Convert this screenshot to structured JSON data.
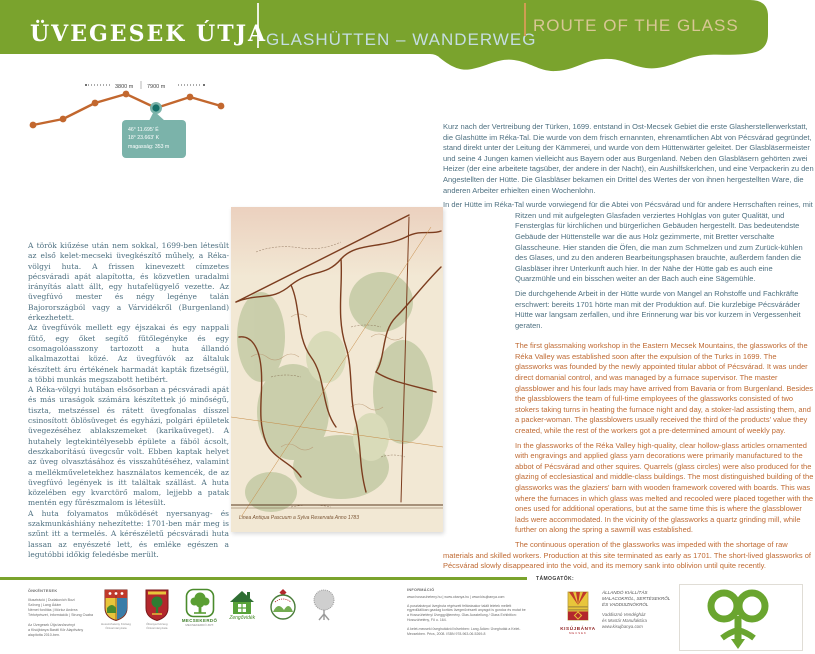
{
  "header": {
    "title_hu": "ÜVEGESEK ÚTJA",
    "title_de": "GLASHÜTTEN – WANDERWEG",
    "title_en": "ROUTE OF THE GLASS",
    "band_color": "#7aa32d",
    "title_de_color": "#c5dde2",
    "title_en_color": "#d9c795"
  },
  "chart_data": {
    "type": "line",
    "title": "trail elevation profile",
    "distance_labels": [
      "3800 m",
      "7900 m"
    ],
    "x_rel": [
      15,
      45,
      77,
      108,
      138,
      172,
      203
    ],
    "y_rel": [
      49,
      43,
      27,
      18,
      32,
      21,
      30
    ],
    "highlight_index": 4,
    "tooltip": [
      "46° 11.695' É",
      "18° 23.663' K",
      "magasság: 353 m"
    ],
    "line_color": "#c2672e",
    "highlight_color": "#156f68",
    "highlight_ring": "#7bb3aa",
    "tooltip_color": "#7bb3aa"
  },
  "text": {
    "hu": "A török kiűzése után nem sokkal, 1699-ben létesült az első kelet-mecseki üvegkészítő műhely, a Réka-völgyi huta. A frissen kinevezett címzetes pécsváradi apát alapította, és közvetlen uradalmi irányítás alatt állt, egy hutafelügyelő vezette. Az üvegfúvó mester és négy legénye talán Bajorországból vagy a Várvidékről (Burgenland) érkezhetett.\nAz üvegfúvók mellett egy éjszakai és egy nappali fűtő, egy őket segítő fűtőlegényke és egy csomagolóasszony tartozott a huta állandó alkalmazottai közé. Az üvegfúvók az általuk készített áru értékének harmadát kapták fizetségül, a többi munkás megszabott hetibért.\nA Réka-völgyi hutában elsősorban a pécsváradi apát és más uraságok számára készítettek jó minőségű, tiszta, metszéssel és rátett üvegfonalas dísszel csinosított öblösüveget és egyházi, polgári épületek üvegezéséhez ablakszemeket (karikaüveget). A hutahely legtekintélyesebb épülete a fából ácsolt, deszkaborítású üvegcsűr volt. Ebben kaptak helyet az üveg olvasztásához és visszahűtéséhez, valamint a mellékműveletekhez használatos kemencék, de az üvegfúvó legények is itt találtak szállást. A huta közelében egy kvarctörő malom, lejjebb a patak mentén egy fűrészmalom is létesült.\nA huta folyamatos működését nyersanyag- és szakmunkáshiány nehezítette: 1701-ben már meg is szűnt itt a termelés. A kérészéletű pécsváradi huta lassan az enyészeté lett, és emléke egészen a legutóbbi időkig feledésbe merült.",
    "de": [
      "Kurz nach der Vertreibung der Türken, 1699. entstand in Ost-Mecsek Gebiet die erste Glasherstellerwerkstatt, die Glashütte im Réka-Tal. Die wurde von dem frisch ernannten, ehrenamtlichen Abt von Pécsvárad gegründet, stand direkt unter der Leitung der Kämmerei, und wurde von dem Hüttenwärter geleitet. Der Glasbläsermeister und seine 4 Jungen kamen vielleicht aus Bayern oder aus Burgenland. Neben den Glasbläsern gehörten zwei Heizer (der eine arbeitete tagsüber, der andere in der Nacht), ein Aushilfskerlchen, und eine Verpackerin zu den Angestellten der Hütte. Die Glasbläser bekamen ein Drittel des Wertes der von ihnen hergestellten Ware, die anderen Arbeiter erhielten einen Wochenlohn.",
      "In der Hütte im Réka-Tal wurde vorwiegend für die Abtei von Pécsvárad und für andere Herrschaften reines, mit Ritzen und mit aufgelegten Glasfaden verziertes Hohlglas von guter Qualität, und Fensterglas für kirchlichen und bürgerlichen Gebäuden hergestellt. Das bedeutendste Gebäude der Hüttenstelle war die aus Holz gezimmerte, mit Bretter verschalte Glasscheune. Hier standen die Öfen, die man zum Schmelzen und zum Zurück-kühlen des Glases, und zu den anderen Bearbeitungsphasen brauchte, außerdem fanden die Glasbläser ihrer Unterkunft auch hier. In der Nähe der Hütte gab es auch eine Quarzmühle und ein bisschen weiter an der Bach auch eine Sägemühle.",
      "Die durchgehende Arbeit in der Hütte wurde von Mangel an Rohstoffe und Fachkräfte erschwert: bereits 1701 hörte man mit der Produktion auf. Die kurzlebige Pécsváráder Hütte war langsam zerfallen, und ihre Erinnerung war bis vor kurzem in Vergessenheit geraten."
    ],
    "en": [
      "The first glassmaking workshop in the Eastern Mecsek Mountains, the glassworks of the Réka Valley was established soon after the expulsion of the Turks in 1699. The glassworks was founded by the newly appointed titular abbot of Pécsvárad. It was under direct domanial control, and was managed by a furnace supervisor. The master glassblower and his four lads may have arrived from Bavaria or from Burgenland. Besides the glassblowers the team of full-time employees of the glassworks consisted of two stokers taking turns in heating the furnace night and day, a stoker-lad assisting them, and a packer-woman. The glassblowers usually received the third of the products' value they created, while the rest of the workers got a pre-determined amount of weekly pay.",
      "In the glassworks of the Réka Valley high-quality, clear hollow-glass articles ornamented with engravings and applied glass yarn decorations were primarily manufactured to the abbot of Pécsvárad and other squires. Quarrels (glass circles) were also produced for the glazing of ecclesiastical and middle-class buildings. The most distinguished building of the glassworks was the glaziers' barn with wooden framework covered with boards. This was where the furnaces in which glass was melted and recooled were placed together with the ones used for additional operations, but at the same time this is where the glassblower lads were accommodated. In the vicinity of the glassworks a quartz grinding mill, while further on along the spring a sawmill was established.",
      "The continuous operation of the glassworks was impeded with the shortage of raw materials and skilled workers. Production at this site terminated as early as 1701. The short-lived glassworks of Pécsvárad slowly disappeared into the void, and its memory sank into oblivion until quite recently."
    ]
  },
  "map": {
    "caption": "Linea Antiqua Pascuum a Sylva Reservata Anno 1783"
  },
  "footer": {
    "credits": {
      "heading": "ÖNKÉNTESEK",
      "lines": [
        "Illusztráció | Dudakovich Bozi",
        "Szöveg | Lang Ádám",
        "Német fordítás | Móricz Andrea",
        "Térképészet, információk | Strung Csaba"
      ],
      "note": "Az Üvegesek Útja tanösvényt\na Kisújbánya Baráti Kör Alapítvány\nalapította 2010-ben."
    },
    "logos": [
      {
        "caption": "Hosszúhetény Község\nÖnkormányzata"
      },
      {
        "caption": "Óbánya Község\nÖnkormányzata"
      },
      {
        "caption": "MECSEKERDŐ",
        "subcaption": "MECSEKERDŐ ZRT."
      },
      {
        "caption": "Zengővidék"
      }
    ],
    "info": {
      "heading": "INFORMÁCIÓ",
      "urls": "www.hosszuheteny.hu | www.obanya.hu | www.kisujbanya.com",
      "text1": "A pusztabányai üveghuta régészeti feltárásakor talált leletek mellett egyedülállóan gazdag kortárs üvegművészeti anyagot is gondoz és mutat be a Hosszúhetényi Üveggyűjtemény. Glas Ausstellung / Glass Exhibition: Hosszúhetény, Fő u. 164.",
      "text2": "A kelet-mecseki üveghutákról bővebben: Lang Ádám: Üveghuták a Kelet-Mecsekben. Pécs, 2008. ISBN 978-963-06-5269-8"
    },
    "supporters": {
      "heading": "TÁMOGATÓK:",
      "kisujbanya_name": "KISÚJBÁNYA",
      "kisujbanya_sub": "MECSEK",
      "exhibition": "Állandó kiállítás\nmalacokról, sertésekről\nés vaddisznókról",
      "venue": "Vaddisznó Vendégház\nés Mustár Manufaktúra\nwww.kisujbanya.com"
    }
  }
}
